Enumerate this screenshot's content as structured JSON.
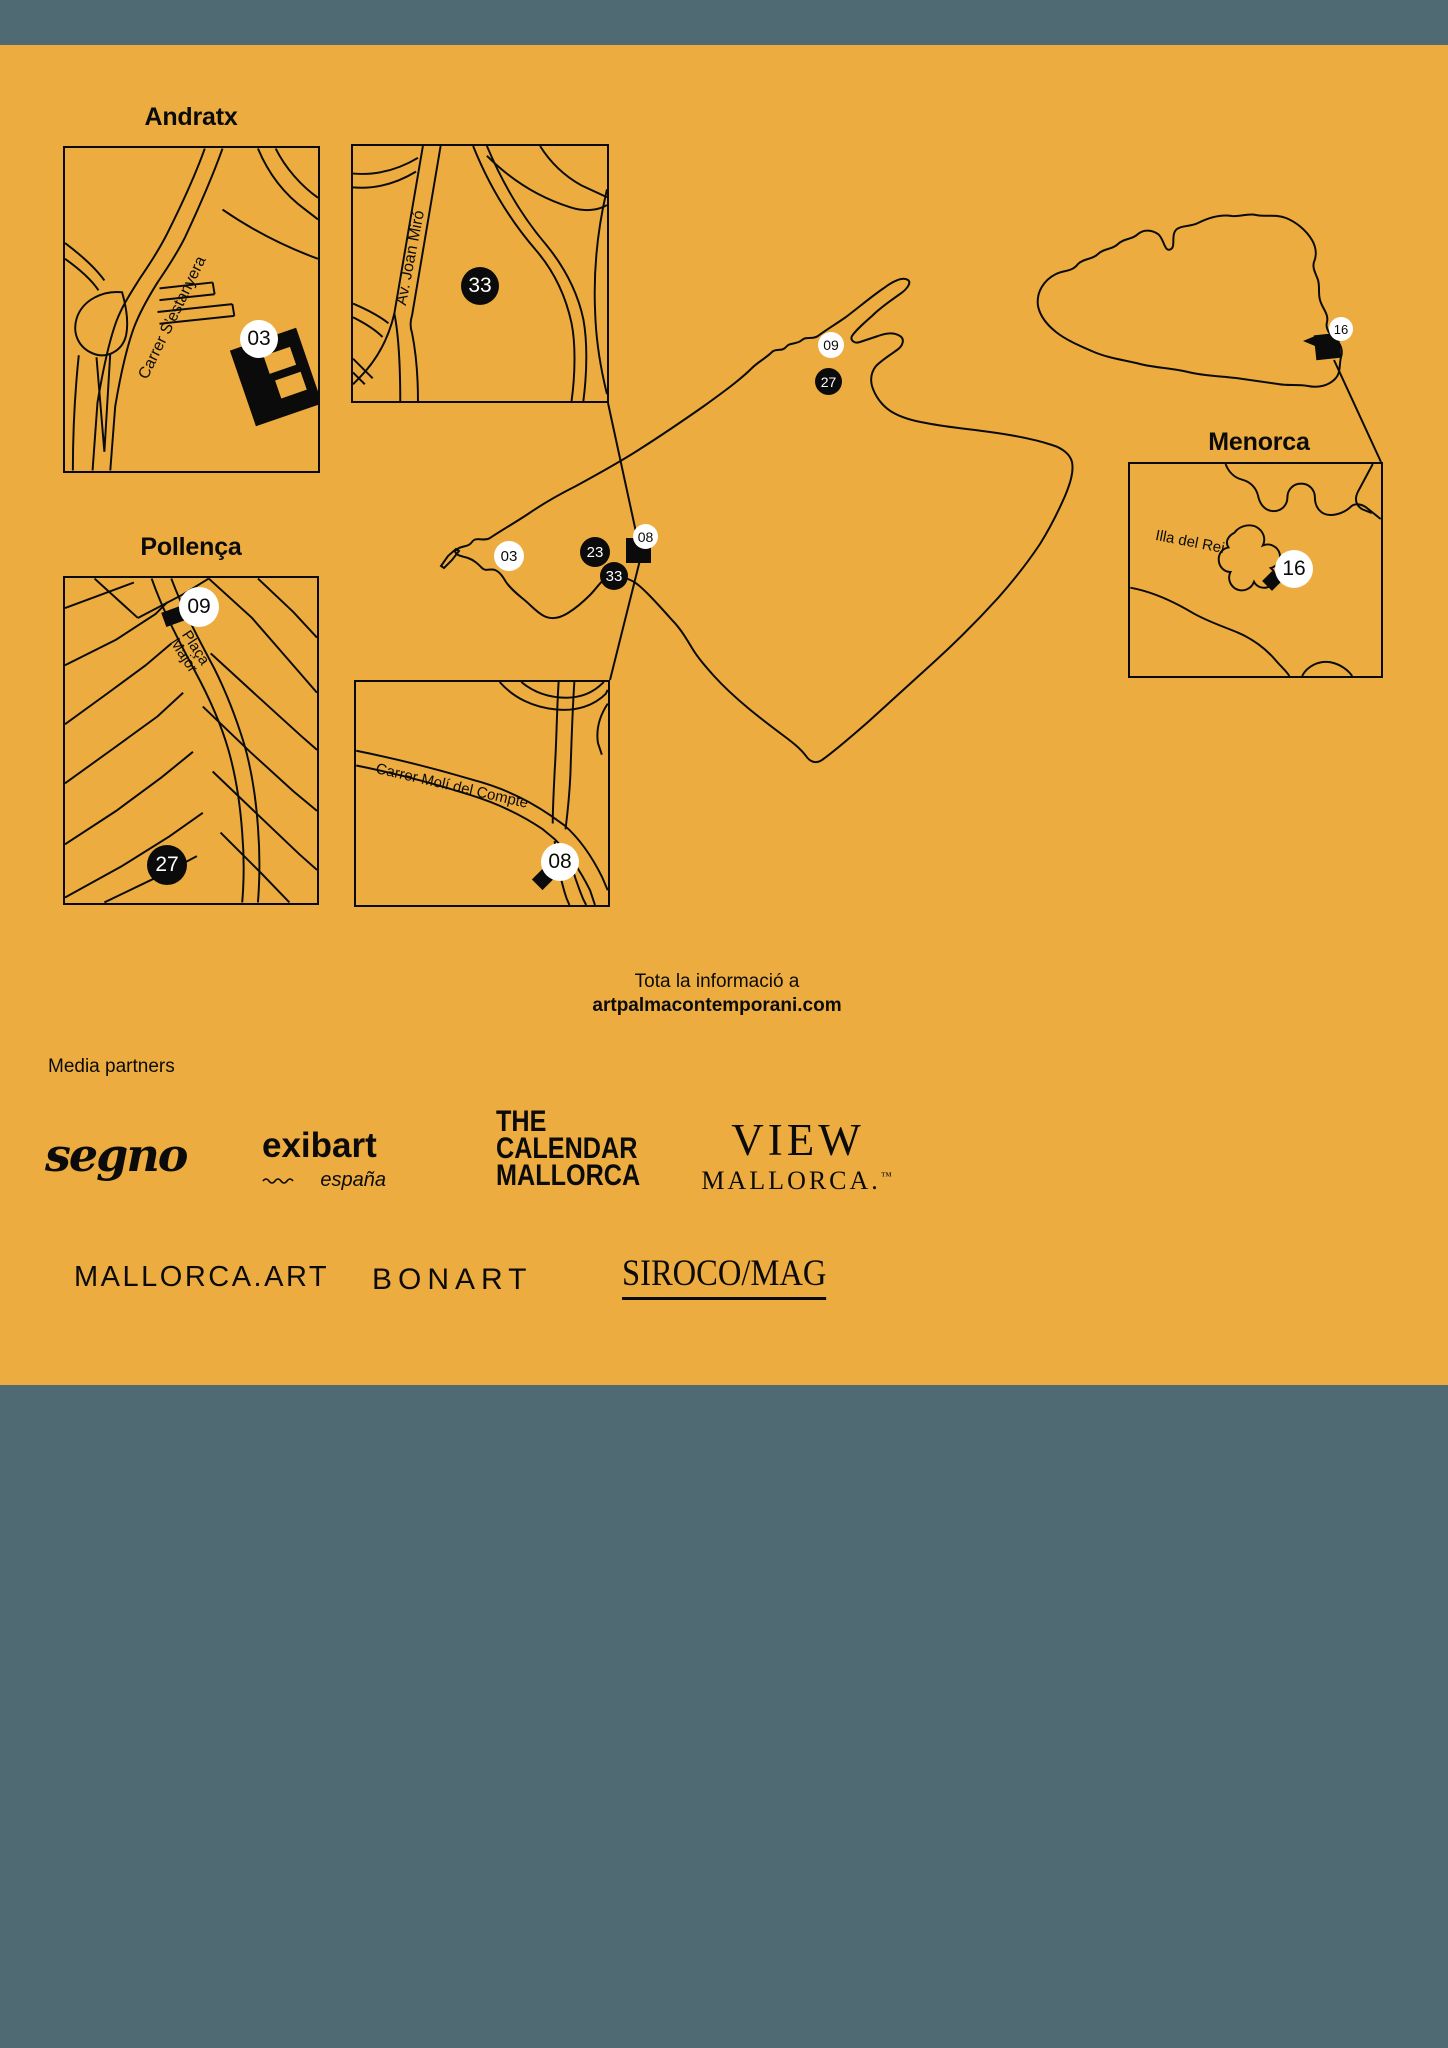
{
  "poster": {
    "colors": {
      "orange": "#ECAC3F",
      "teal": "#4F6A72",
      "ink": "#0B0B0B",
      "white": "#FFFFFF"
    }
  },
  "maps": {
    "andratx": {
      "title": "Andratx",
      "street": "Carrer S’estanyera",
      "marker": "03"
    },
    "palma": {
      "street": "Av. Joan Miró",
      "marker": "33"
    },
    "pollenca": {
      "title": "Pollença",
      "place1": "Plaça",
      "place2": "Major",
      "marker_top": "09",
      "marker_bottom": "27"
    },
    "moli": {
      "street": "Carrer Molí del Compte",
      "marker": "08"
    },
    "menorca_inset": {
      "title": "Menorca",
      "island": "Illa del Rei",
      "marker": "16"
    },
    "mallorca_markers": {
      "m09": "09",
      "m27": "27",
      "m03": "03",
      "m23": "23",
      "m33": "33",
      "m08": "08"
    },
    "menorca_marker": "16"
  },
  "info": {
    "line1": "Tota la informació a",
    "line2": "artpalmacontemporani.com"
  },
  "partners": {
    "heading": "Media partners",
    "segno": "segno",
    "exibart": "exibart",
    "exibart_region": "españa",
    "calendar": [
      "THE",
      "CALENDAR",
      "MALLORCA"
    ],
    "view": "VIEW",
    "view_sub": "MALLORCA.",
    "view_tm": "™",
    "mallorca_art": "MALLORCA.ART",
    "bonart": "BONART",
    "siroco": "SIROCO/MAG"
  }
}
